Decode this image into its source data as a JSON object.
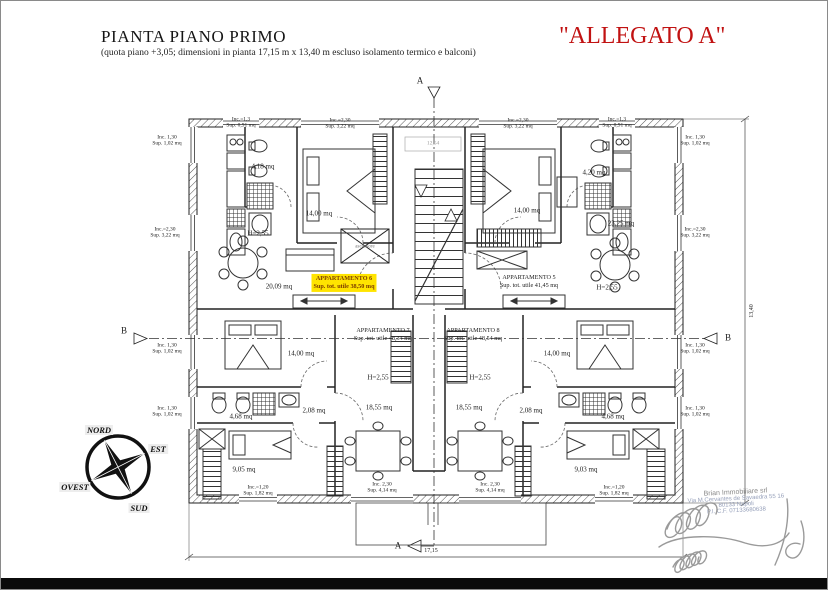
{
  "header": {
    "title": "PIANTA PIANO PRIMO",
    "subtitle": "(quota piano +3,05; dimensioni in pianta 17,15 m x 13,40 m escluso isolamento termico e balconi)",
    "allegato": "\"ALLEGATO A\""
  },
  "colors": {
    "allegato": "#c11212",
    "highlight": "#ffe400",
    "highlight_text": "#7c3c00",
    "line": "#222222"
  },
  "plan": {
    "apartments": [
      {
        "name": "APPARTAMENTO 6",
        "area": "Sup. tot. utile 38,50 mq",
        "x": 343,
        "y": 282,
        "hl": true
      },
      {
        "name": "APPARTAMENTO 5",
        "area": "Sup. tot. utile 41,45 mq",
        "x": 528,
        "y": 281,
        "hl": false
      },
      {
        "name": "APPARTAMENTO 7",
        "area": "Sup. tot. utile 48,34 mq",
        "x": 382,
        "y": 334,
        "hl": false
      },
      {
        "name": "APPARTAMENTO 8",
        "area": "Sup. tot. utile 48,54 mq",
        "x": 472,
        "y": 334,
        "hl": false
      }
    ],
    "labels": [
      {
        "t": "4,18 mq",
        "x": 262,
        "y": 166
      },
      {
        "t": "14,00 mq",
        "x": 318,
        "y": 213
      },
      {
        "t": "H=2,55",
        "x": 257,
        "y": 233
      },
      {
        "t": "20,09 mq",
        "x": 278,
        "y": 286
      },
      {
        "t": "4,20 mq",
        "x": 593,
        "y": 172
      },
      {
        "t": "14,00 mq",
        "x": 526,
        "y": 210
      },
      {
        "t": "23,25 mq",
        "x": 620,
        "y": 223
      },
      {
        "t": "H=2,55",
        "x": 606,
        "y": 287
      },
      {
        "t": "14,00 mq",
        "x": 300,
        "y": 353
      },
      {
        "t": "H=2,55",
        "x": 377,
        "y": 377
      },
      {
        "t": "4,68 mq",
        "x": 240,
        "y": 416
      },
      {
        "t": "2,08 mq",
        "x": 313,
        "y": 410
      },
      {
        "t": "18,55 mq",
        "x": 378,
        "y": 407
      },
      {
        "t": "9,05 mq",
        "x": 243,
        "y": 469
      },
      {
        "t": "14,00 mq",
        "x": 556,
        "y": 353
      },
      {
        "t": "H=2,55",
        "x": 479,
        "y": 377
      },
      {
        "t": "4,68 mq",
        "x": 612,
        "y": 416
      },
      {
        "t": "2,08 mq",
        "x": 530,
        "y": 410
      },
      {
        "t": "18,55 mq",
        "x": 468,
        "y": 407
      },
      {
        "t": "9,03 mq",
        "x": 585,
        "y": 469
      },
      {
        "t": "ascensore",
        "x": 364,
        "y": 246,
        "s": 5,
        "c": "#777777",
        "n": "elevator-label"
      },
      {
        "t": "12,54",
        "x": 432,
        "y": 143,
        "s": 5.5,
        "c": "#999999",
        "n": "landing-dim-label"
      },
      {
        "t": "Inc. 1,30",
        "x": 166,
        "y": 137,
        "s": 5.5,
        "n": "window-label"
      },
      {
        "t": "Sup. 1,02 mq",
        "x": 166,
        "y": 143,
        "s": 5.5,
        "n": "window-label"
      },
      {
        "t": "Inc.=2,30",
        "x": 164,
        "y": 229,
        "s": 5.5,
        "n": "window-label"
      },
      {
        "t": "Sup. 3,22 mq",
        "x": 164,
        "y": 235,
        "s": 5.5,
        "n": "window-label"
      },
      {
        "t": "Inc. 1,30",
        "x": 166,
        "y": 345,
        "s": 5.5,
        "n": "window-label"
      },
      {
        "t": "Sup. 1,02 mq",
        "x": 166,
        "y": 351,
        "s": 5.5,
        "n": "window-label"
      },
      {
        "t": "Inc. 1,30",
        "x": 166,
        "y": 408,
        "s": 5.5,
        "n": "window-label"
      },
      {
        "t": "Sup. 1,02 mq",
        "x": 166,
        "y": 414,
        "s": 5.5,
        "n": "window-label"
      },
      {
        "t": "Inc. 1,30",
        "x": 694,
        "y": 137,
        "s": 5.5,
        "n": "window-label"
      },
      {
        "t": "Sup. 1,02 mq",
        "x": 694,
        "y": 143,
        "s": 5.5,
        "n": "window-label"
      },
      {
        "t": "Inc.=2,30",
        "x": 694,
        "y": 229,
        "s": 5.5,
        "n": "window-label"
      },
      {
        "t": "Sup. 3,22 mq",
        "x": 694,
        "y": 235,
        "s": 5.5,
        "n": "window-label"
      },
      {
        "t": "Inc. 1,30",
        "x": 694,
        "y": 345,
        "s": 5.5,
        "n": "window-label"
      },
      {
        "t": "Sup. 1,02 mq",
        "x": 694,
        "y": 351,
        "s": 5.5,
        "n": "window-label"
      },
      {
        "t": "Inc. 1,30",
        "x": 694,
        "y": 408,
        "s": 5.5,
        "n": "window-label"
      },
      {
        "t": "Sup. 1,02 mq",
        "x": 694,
        "y": 414,
        "s": 5.5,
        "n": "window-label"
      },
      {
        "t": "Inc.=1,3",
        "x": 240,
        "y": 119,
        "s": 5.5,
        "n": "window-label"
      },
      {
        "t": "Sup. 0,91 mq",
        "x": 240,
        "y": 125,
        "s": 5.5,
        "n": "window-label"
      },
      {
        "t": "Inc.=2,30",
        "x": 339,
        "y": 120,
        "s": 5.5,
        "n": "window-label"
      },
      {
        "t": "Sup. 3,22 mq",
        "x": 339,
        "y": 126,
        "s": 5.5,
        "n": "window-label"
      },
      {
        "t": "Inc.=2,30",
        "x": 517,
        "y": 120,
        "s": 5.5,
        "n": "window-label"
      },
      {
        "t": "Sup. 3,22 mq",
        "x": 517,
        "y": 126,
        "s": 5.5,
        "n": "window-label"
      },
      {
        "t": "Inc.=1,3",
        "x": 616,
        "y": 119,
        "s": 5.5,
        "n": "window-label"
      },
      {
        "t": "Sup. 0,91 mq",
        "x": 616,
        "y": 125,
        "s": 5.5,
        "n": "window-label"
      },
      {
        "t": "Inc.=1,20",
        "x": 257,
        "y": 487,
        "s": 5.5,
        "n": "window-label"
      },
      {
        "t": "Sup. 1,82 mq",
        "x": 257,
        "y": 493,
        "s": 5.5,
        "n": "window-label"
      },
      {
        "t": "Inc. 2,30",
        "x": 381,
        "y": 484,
        "s": 5.5,
        "n": "window-label"
      },
      {
        "t": "Sup. 4,14 mq",
        "x": 381,
        "y": 490,
        "s": 5.5,
        "n": "window-label"
      },
      {
        "t": "Inc. 2,30",
        "x": 489,
        "y": 484,
        "s": 5.5,
        "n": "window-label"
      },
      {
        "t": "Sup. 4,14 mq",
        "x": 489,
        "y": 490,
        "s": 5.5,
        "n": "window-label"
      },
      {
        "t": "Inc.=1,20",
        "x": 613,
        "y": 487,
        "s": 5.5,
        "n": "window-label"
      },
      {
        "t": "Sup. 1,82 mq",
        "x": 613,
        "y": 493,
        "s": 5.5,
        "n": "window-label"
      },
      {
        "t": "17,15",
        "x": 430,
        "y": 550,
        "s": 6,
        "n": "dimension-width"
      },
      {
        "t": "13,40",
        "x": 751,
        "y": 310,
        "s": 6,
        "r": -90,
        "n": "dimension-height"
      },
      {
        "t": "A",
        "x": 419,
        "y": 80,
        "s": 9,
        "n": "section-marker-a-top"
      },
      {
        "t": "A",
        "x": 397,
        "y": 545,
        "s": 9,
        "n": "section-marker-a-bottom"
      },
      {
        "t": "B",
        "x": 123,
        "y": 330,
        "s": 9,
        "n": "section-marker-b-left"
      },
      {
        "t": "B",
        "x": 727,
        "y": 337,
        "s": 9,
        "n": "section-marker-b-right"
      }
    ]
  },
  "compass": {
    "n": "NORD",
    "e": "EST",
    "s": "SUD",
    "w": "OVEST"
  },
  "stamp": {
    "line1": "Brian Immobiliare srl",
    "line2": "Via M.Cervantes de Savaedra 55 16",
    "line3": "80133 Napoli",
    "line4": "P.I. C.F. 07133680638"
  }
}
